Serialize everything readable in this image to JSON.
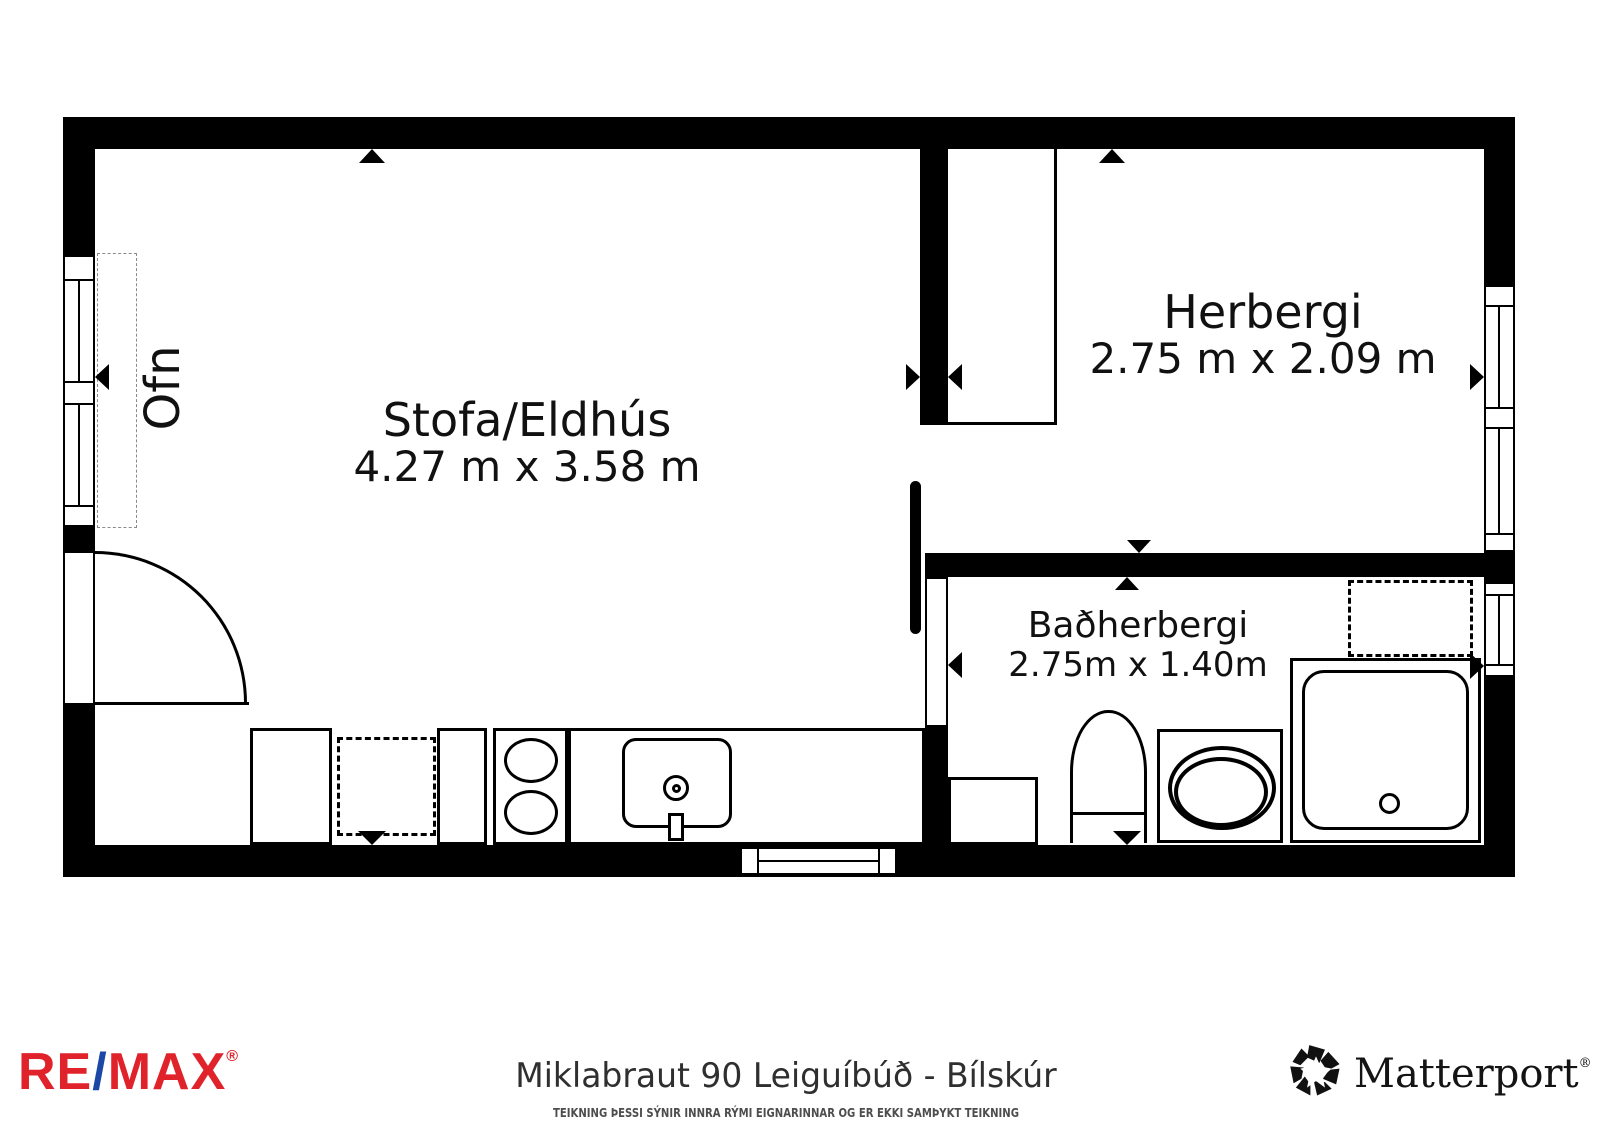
{
  "plan": {
    "rooms": [
      {
        "name": "Stofa/Eldhús",
        "dimensions": "4.27 m x 3.58 m"
      },
      {
        "name": "Herbergi",
        "dimensions": "2.75 m x 2.09 m"
      },
      {
        "name": "Baðherbergi",
        "dimensions": "2.75m x 1.40m"
      }
    ],
    "radiator_label": "Ofn"
  },
  "footer": {
    "remax": {
      "re": "RE",
      "slash": "/",
      "max": "MAX",
      "registered": "®"
    },
    "title": "Miklabraut 90 Leiguíbúð - Bílskúr",
    "disclaimer": "TEIKNING ÞESSI SÝNIR INNRA RÝMI EIGNARINNAR OG ER EKKI SAMÞYKT TEIKNING",
    "matterport": {
      "name": "Matterport",
      "registered": "®"
    }
  },
  "colors": {
    "wall": "#000000",
    "background": "#ffffff",
    "remax_red": "#E0232B",
    "remax_blue": "#1B47A7",
    "title_text": "#2f2f2f",
    "disclaimer_text": "#4d4d4d"
  }
}
